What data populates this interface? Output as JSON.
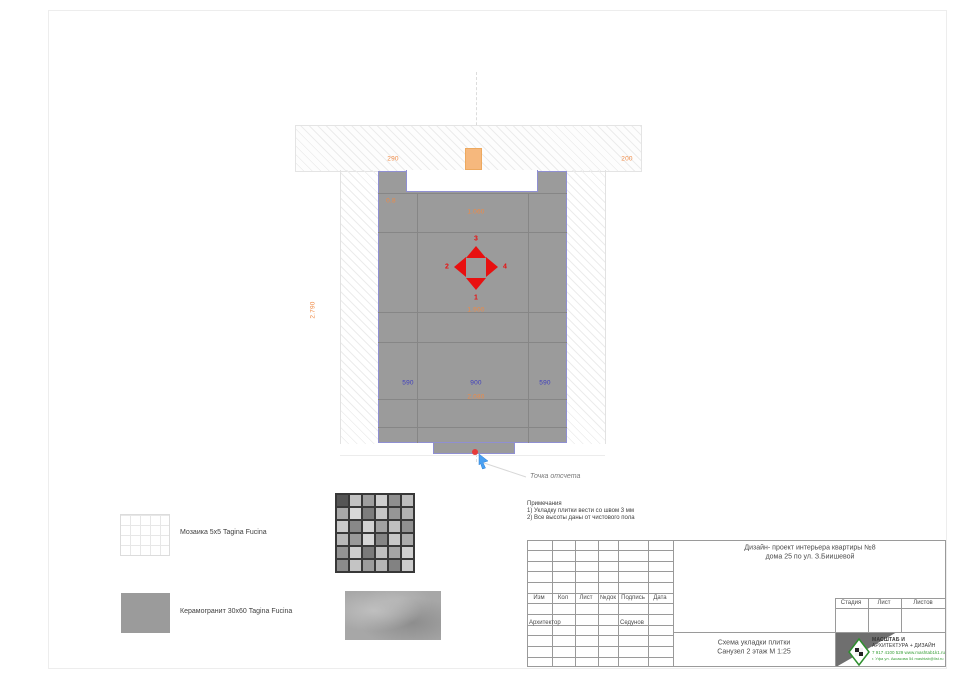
{
  "drawing": {
    "dims": {
      "top_left": "290",
      "top_right": "200",
      "wall_height": "2.790",
      "niche_width": "1.060",
      "level_mark": "0.8",
      "center_offset": "1.900",
      "total_width": "2.080",
      "bottom_left": "590",
      "bottom_mid": "900",
      "bottom_right": "590"
    },
    "arrows": {
      "up": "3",
      "down": "1",
      "left": "2",
      "right": "4"
    },
    "reference_label": "Точка отсчета"
  },
  "notes": {
    "title": "Примечания",
    "items": [
      "1) Укладку плитки вести со швом 3 мм",
      "2) Все высоты даны от чистового пола"
    ]
  },
  "legend": [
    {
      "label": "Мозаика 5х5  Tagina Fucina"
    },
    {
      "label": "Керамогранит  30х60  Tagina Fucina"
    }
  ],
  "titleblock": {
    "project_line1": "Дизайн- проект интерьера квартиры №8",
    "project_line2": "дома 25  по ул. З.Биишевой",
    "columns": [
      "Изм",
      "Кол",
      "Лист",
      "№док",
      "Подпись",
      "Дата"
    ],
    "role": "Архитектор",
    "name": "Седунов",
    "stage_headers": [
      "Стадия",
      "Лист",
      "Листов"
    ],
    "sheet_line1": "Схема укладки плитки",
    "sheet_line2": "Санузел 2 этаж М 1:25",
    "logo": {
      "line1": "МАСШТАБ И",
      "line2": "АРХИТЕКТУРА + ДИЗАЙН",
      "line3": "7 917 4100 529  www.mashtab1k1.ru",
      "line4": "г. Уфа ул. Аксакова 54  mashtab@list.ru"
    }
  },
  "colors": {
    "dim_orange": "#ef8a45",
    "dim_blue": "#3d3dbe",
    "arrow_red": "#e81010",
    "tile_gray": "#9b9b9b",
    "outline_purple": "#8f8fd2",
    "logo_green": "#2f8f2f"
  }
}
